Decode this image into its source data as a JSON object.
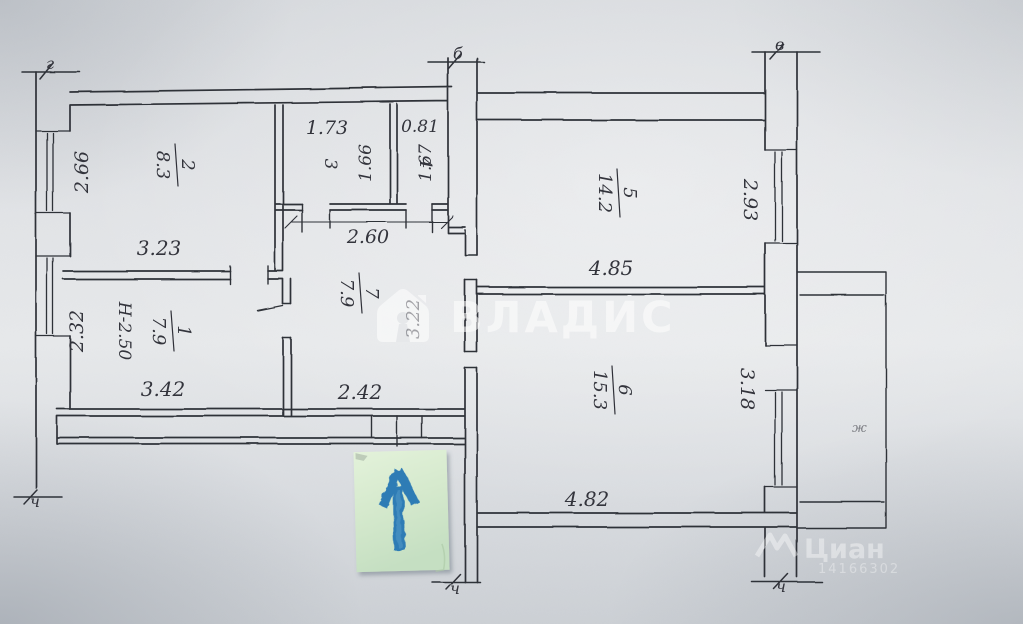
{
  "plan": {
    "rooms": {
      "r1": {
        "number": "1",
        "area": "7.9",
        "height_note": "Н-2.50"
      },
      "r2": {
        "number": "2",
        "area": "8.3"
      },
      "r3": {
        "number": "3"
      },
      "r4": {
        "number": "4"
      },
      "r5": {
        "number": "5",
        "area": "14.2"
      },
      "r6": {
        "number": "6",
        "area": "15.3"
      },
      "r7": {
        "number": "7",
        "area": "7.9"
      }
    },
    "dimensions": {
      "room2_width": "2.66",
      "room2_length": "3.23",
      "room1_width": "2.32",
      "room1_length": "3.42",
      "room3_width": "1.73",
      "room3_depth": "1.66",
      "room4_width": "0.81",
      "room4_depth": "1.67",
      "hall_width": "2.60",
      "hall_depth": "3.22",
      "hall_entry": "2.42",
      "room5_length": "4.85",
      "room5_width": "2.93",
      "room6_length": "4.82",
      "room6_width": "3.18"
    },
    "axis_marks": {
      "top_left": "г",
      "top_middle": "б",
      "top_right": "в",
      "bottom_left": "ч",
      "bottom_middle": "ч",
      "bottom_right": "ч"
    },
    "balcony_mark": "ж",
    "ink_color": "#2f3038"
  },
  "watermarks": {
    "center": {
      "brand": "ВЛАДИС"
    },
    "corner": {
      "brand": "Циан",
      "listing_id": "14166302"
    }
  },
  "sticky_note": {
    "arrow": "up-arrow",
    "note_color": "#d5e9cd",
    "arrow_color": "#2e7cb5"
  }
}
